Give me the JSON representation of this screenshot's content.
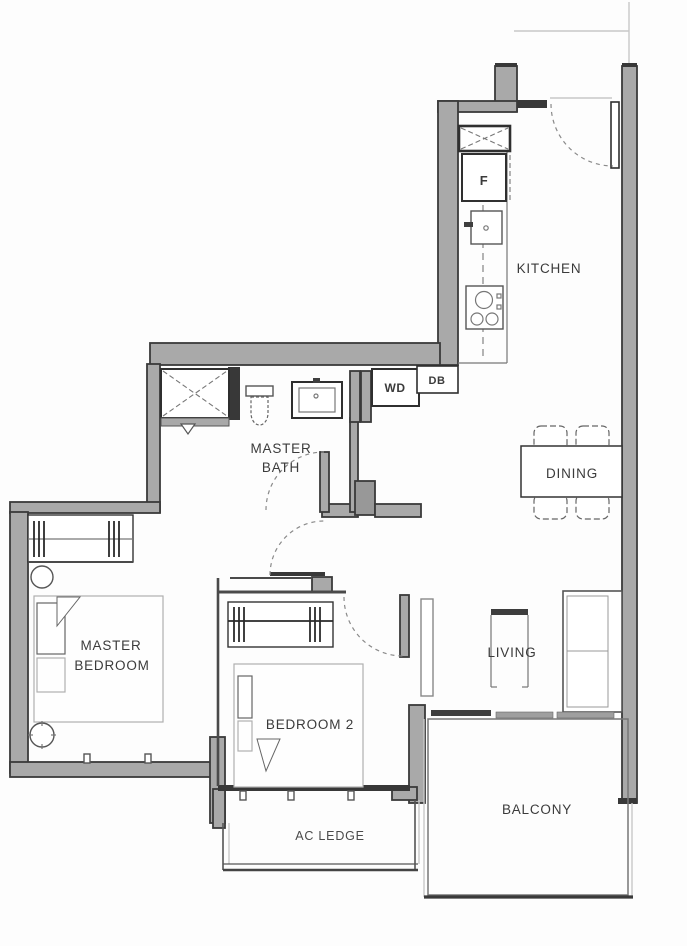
{
  "labels": {
    "kitchen": "KITCHEN",
    "dining": "DINING",
    "living": "LIVING",
    "balcony": "BALCONY",
    "ac_ledge": "AC LEDGE",
    "bedroom2": "BEDROOM 2",
    "master_bath": [
      "MASTER",
      "BATH"
    ],
    "master_bedroom": [
      "MASTER",
      "BEDROOM"
    ],
    "fridge": "F",
    "washer_dryer": "WD",
    "distribution_board": "DB"
  },
  "colors": {
    "wall_fill": "#a9a9a9",
    "wall_outline": "#333333",
    "furniture_line": "#555555",
    "text": "#3b3b3b",
    "background": "#ffffff"
  }
}
